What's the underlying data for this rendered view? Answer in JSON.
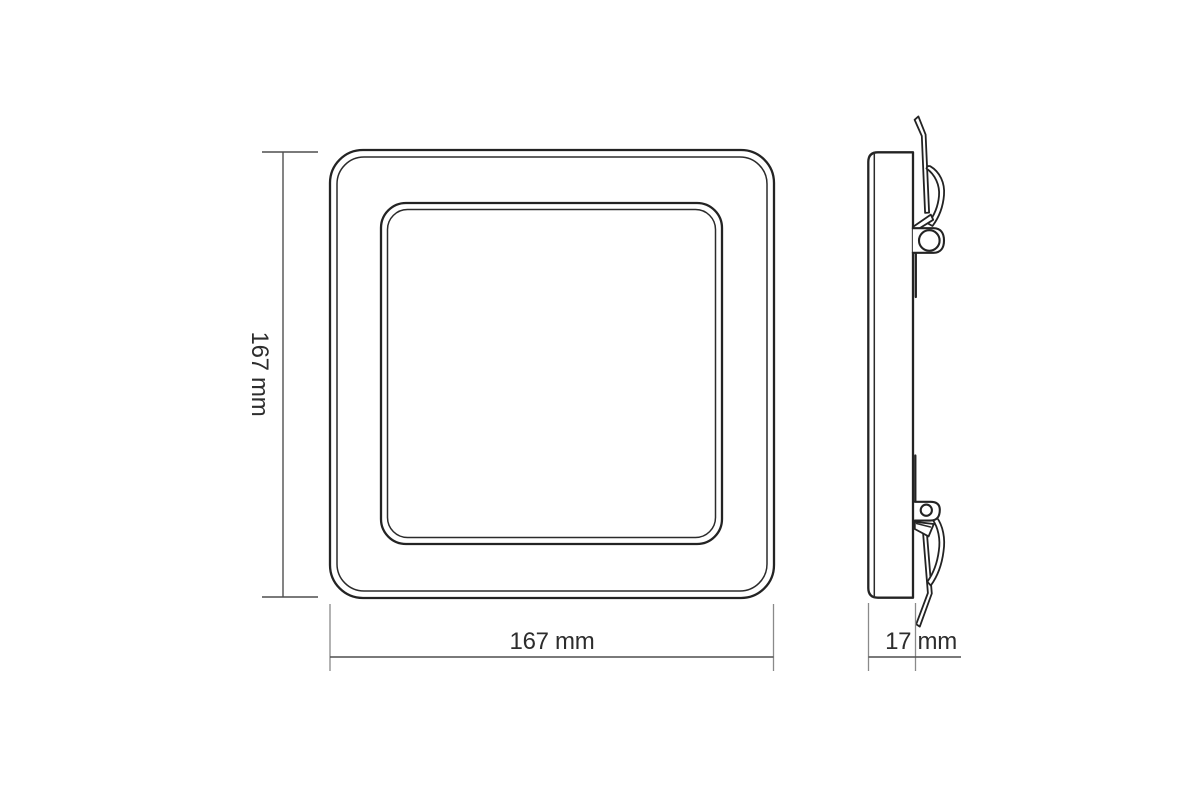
{
  "colors": {
    "background": "#ffffff",
    "part_outline": "#232323",
    "dimension_line": "#4f4f4f",
    "extension_line": "#8a8a8a",
    "label_text": "#2d2d2d"
  },
  "dimensions": {
    "height": {
      "label": "167 mm"
    },
    "width": {
      "label": "167 mm"
    },
    "depth": {
      "label": "17 mm"
    }
  }
}
